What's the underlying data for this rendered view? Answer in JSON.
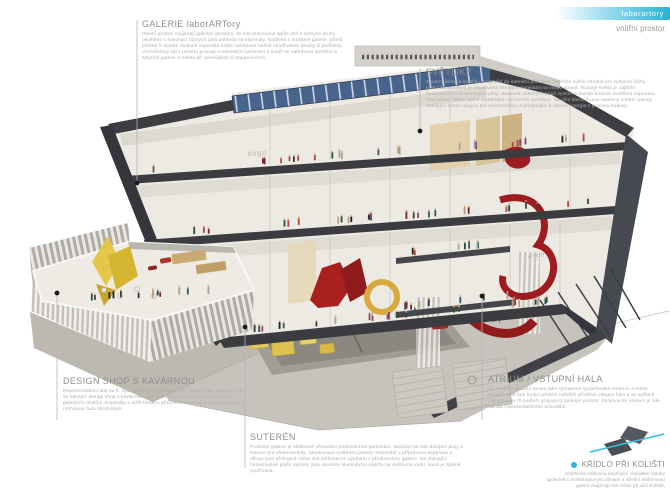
{
  "title_bar": {
    "brand_label": "laborartory",
    "subtitle": "vnitřní prostor",
    "accent_color": "#2ab5da"
  },
  "annotations": {
    "galerie": {
      "title": "GALERIE laborARTory",
      "body": "Hlavní prostor zaujímají galerijní prostory. Je zde pracováno spíše než s různými druhy osvětlení s koncepcí různých úhlů pohledu na exponáty. Nadhled z mostové galerie, přímý pohled či spodní studium exponátů může nabídnout běžně neodhalené detaily či podhledy. Víceúčelový sál v parteru pracuje s městským parterem a snaží se nabídnout otevření a splynutí galerie a města při vernisážích či happeninzích."
    },
    "svetliky": {
      "title": "SVĚTLÍKY",
      "body": "Severní šikmina světlíku propouští do interiéru přirozené nepřímé světlo vhodné pro výstavní účely. Intenzita osvětlení je regulována filtrovými lamelami na vnější straně. Rozptyl světla je zajištěn horizontálními screenovými pásy. Zasunutí některých pásů vytvoří scénické bodové osvětlení exponátu. Toto řešení nabízí úplné zatemnění i přirozené osvětlení. Na jižní šikmině jsou osazeny solární panely dobíjející stanici plug in pro elektromobily a přispívající k úspoře energie z provozu budovy."
    },
    "atrium": {
      "title": "ATRIUM / VSTUPNÍ HALA",
      "body": "Již v antice sloužilo atrium jako významné společenské centrum a místo setkání. Zde tuto funkci přebírá rušnější přívětivá vstupní hala a ve vyšších patrech přes tři podlaží propojený galerijní prostor. Spojovacím prvkem je zde spirála reprezentativního schodiště."
    },
    "design_shop": {
      "title": "DESIGN SHOP S KAVÁRNOU",
      "body": "Reprezentativní alej na tř. Kpt. Jaroše je ukončena nižší částí hmoty galerie. V ní se nachází design shop s kavárnou v patře. Střecha kavárny slouží externím galerijním účelům. Exponáty s nižší hmotou přirozeně uzavírají a přidávají jakoby rytmickou řadu stromořadí."
    },
    "suteren": {
      "title": "SUTERÉN",
      "body": "Podzemí galerie je většinově věnováno podzemnímu parkování. Nachází se zde dobíjecí plug in stanice pro elektromobily, zásobovaná solárními panely. Depozitář s přípravnou exponátů a dílnou jsou přístupné mimo jiné stěhovacím výtahem z předprostoru galerie. Na zbývající nezastavěné ploše parcely jsou osazeny akumulační nádrže na dešťovou vodu, která je zpětně využívána."
    },
    "kridlo": {
      "title": "KŘÍDLO PŘI KOLIŠTI",
      "body": "Umělecká knihovna doplňující charakter stavby společně s workshopovými dílnami a střešní ateliérovou galerií zaujímají své místo při ulici Koliště."
    }
  },
  "illustration": {
    "wall_signs": {
      "ground": "labor ART ory",
      "floor_top": "dsgn",
      "floor_mid": "arch"
    },
    "colors": {
      "section_cut": "#34363b",
      "concrete": "#c6c3bc",
      "skylight_glass": "#48648c",
      "accent_red": "#a8211f",
      "accent_yellow": "#d8a93c",
      "accent_cyan": "#2ab5da"
    }
  }
}
